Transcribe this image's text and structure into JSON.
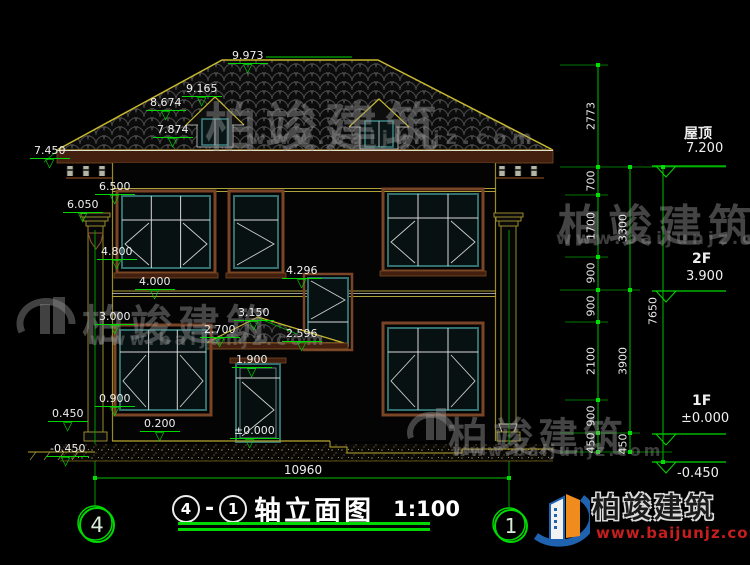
{
  "title": {
    "bubble_left": "4",
    "bubble_right": "1",
    "dash": "-",
    "name": "轴立面图",
    "scale": "1:100"
  },
  "footer": {
    "overall_width": "10960",
    "axis_bubble_left": "4",
    "axis_bubble_right": "1"
  },
  "levels": {
    "roof_label": "屋顶",
    "roof_value": "7.200",
    "f2_label": "2F",
    "f2_value": "3.900",
    "f1_label": "1F",
    "f1_value": "±0.000",
    "ground_value": "-0.450"
  },
  "markers": [
    "9.973",
    "9.165",
    "8.674",
    "7.874",
    "7.450",
    "6.500",
    "6.050",
    "4.800",
    "4.000",
    "4.296",
    "3.150",
    "2.700",
    "2.596",
    "1.900",
    "3.000",
    "0.900",
    "0.450",
    "0.200",
    "±0.000",
    "-0.450"
  ],
  "chains": {
    "c1": [
      "2773",
      "700",
      "1700",
      "900",
      "900",
      "2100",
      "900",
      "450"
    ],
    "c2": [
      "3300",
      "3900",
      "450"
    ],
    "c3": [
      "7650"
    ]
  },
  "watermark": {
    "brand": "柏竣建筑",
    "url": "www.baijunjz.com"
  },
  "logo": {
    "brand": "柏竣建筑",
    "url": "www.baijunjz.com"
  },
  "colors": {
    "dim_green": "#00d800",
    "outline_yellow": "#c9b92f",
    "frame_teal": "#327070",
    "trim_brown": "#7a4526",
    "logo_blue": "#1e62b0",
    "logo_orange": "#f08c1e",
    "url_red": "#c41e1e"
  }
}
